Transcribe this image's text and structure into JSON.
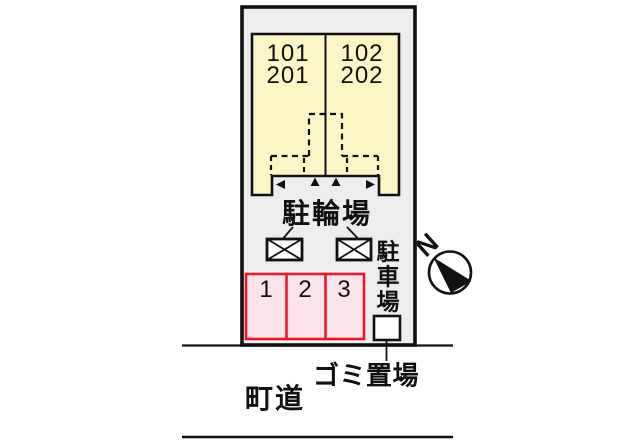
{
  "diagram": {
    "title": "apartment site plan",
    "building": {
      "unit_left": {
        "line1": "101",
        "line2": "201"
      },
      "unit_right": {
        "line1": "102",
        "line2": "202"
      }
    },
    "labels": {
      "bicycle_parking": "駐輪場",
      "car_parking": "駐車場",
      "garbage_area": "ゴミ置場",
      "road": "町道"
    },
    "parking": {
      "stalls": [
        "1",
        "2",
        "3"
      ]
    },
    "compass": {
      "north_label": "N"
    },
    "colors": {
      "building_fill": "#fbf6c6",
      "plot_fill": "#ededed",
      "stall_fill": "#fbe3ea",
      "stall_border": "#e8192d",
      "line": "#111111"
    }
  }
}
